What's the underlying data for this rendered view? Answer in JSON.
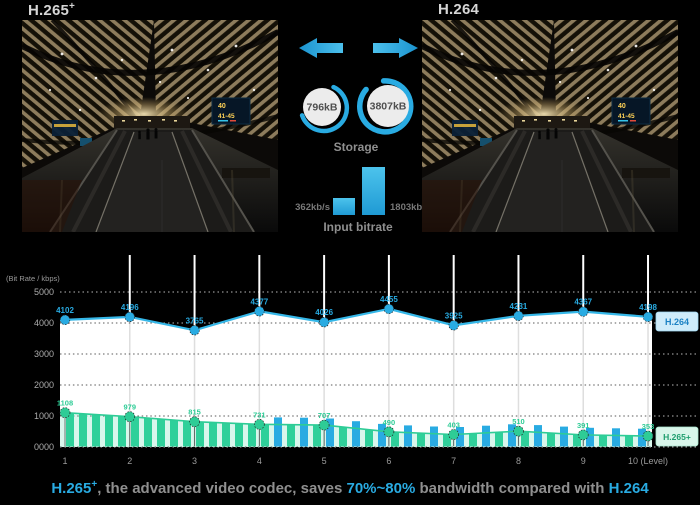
{
  "header": {
    "left": "H.265",
    "left_sup": "+",
    "right": "H.264"
  },
  "photos": {
    "sign_top": "40",
    "sign_bottom": "41-45"
  },
  "transfer": {
    "storage": {
      "label": "Storage",
      "left_value": "796kB",
      "right_value": "3807kB"
    },
    "input_bitrate": {
      "label": "Input bitrate",
      "left_value": "362kb/s",
      "right_value": "1803kb/s"
    }
  },
  "chart_data": {
    "type": "line",
    "ylabel": "(Bit Rate / kbps)",
    "categories": [
      "1",
      "2",
      "3",
      "4",
      "5",
      "6",
      "7",
      "8",
      "9",
      "10 (Level)"
    ],
    "yticks": [
      {
        "label": "5000",
        "value": 5000
      },
      {
        "label": "4000",
        "value": 4000
      },
      {
        "label": "3000",
        "value": 3000
      },
      {
        "label": "2000",
        "value": 2000
      },
      {
        "label": "1000",
        "value": 1000
      },
      {
        "label": "0000",
        "value": 0
      }
    ],
    "ylim": [
      0,
      5000
    ],
    "grid": "dotted",
    "legend_position": "right-tags",
    "series": [
      {
        "name": "H.264",
        "color": "#29abe2",
        "tag_bg": "#cfecfa",
        "tag_text": "#1d82c4",
        "values": [
          4102,
          4196,
          3765,
          4377,
          4026,
          4455,
          3925,
          4231,
          4367,
          4198
        ]
      },
      {
        "name": "H.265+",
        "color": "#2ecc96",
        "tag_bg": "#d9f6ea",
        "tag_text": "#1f9e6e",
        "values": [
          1108,
          979,
          815,
          731,
          707,
          490,
          403,
          510,
          391,
          353
        ]
      }
    ]
  },
  "caption": {
    "codec1": "H.265",
    "codec1_sup": "+",
    "middle1": ", the advanced video codec, saves ",
    "highlight": "70%~80%",
    "middle2": " bandwidth compared with ",
    "codec2": "H.264"
  },
  "colors": {
    "blue": "#29abe2",
    "green": "#2ecc96",
    "caption_gray": "#8f8f8f"
  }
}
